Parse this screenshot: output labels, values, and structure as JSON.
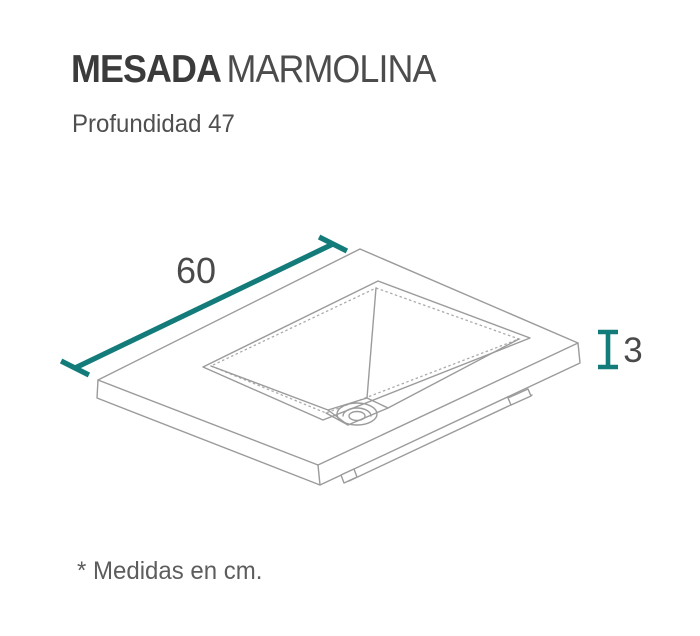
{
  "header": {
    "title_bold": "MESADA",
    "title_regular": "MARMOLINA",
    "subtitle": "Profundidad 47"
  },
  "diagram": {
    "figure": "countertop-sink-isometric-line-drawing",
    "width_label": "60",
    "thickness_label": "3",
    "accent_color": "#137c7b",
    "line_color": "#9b9b9b",
    "label_color": "#4a4a4a"
  },
  "footnote": {
    "text": "* Medidas en cm."
  }
}
